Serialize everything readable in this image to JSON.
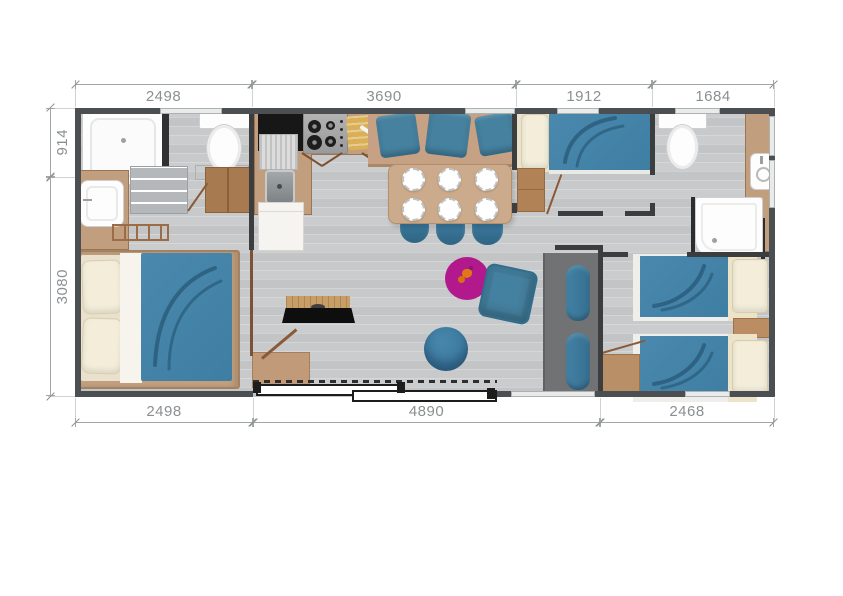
{
  "title": "Mobile home floor plan",
  "dimensions": {
    "top": [
      {
        "label": "2498"
      },
      {
        "label": "3690"
      },
      {
        "label": "1912"
      },
      {
        "label": "1684"
      }
    ],
    "bottom": [
      {
        "label": "2498"
      },
      {
        "label": "4890"
      },
      {
        "label": "2468"
      }
    ],
    "left": [
      {
        "label": "914"
      },
      {
        "label": "3080"
      }
    ]
  },
  "colors": {
    "wall": "#4c4f51",
    "interior_wall": "#3b3d3f",
    "floor_gray": "#c7c9ca",
    "wood_tan": "#c19e7d",
    "fabric_blue": "#4584a9",
    "cushion_blue": "#46829f",
    "pillow_cream": "#f3edda",
    "fixture_white": "#fdfdfd",
    "counter_black": "#171717",
    "sofa_gray": "#707274",
    "rug_magenta": "#b2198c",
    "figure_orange": "#e07818",
    "dimension_text": "#8b8f91",
    "cutting_board": "#d9b058"
  },
  "rooms": {
    "bathroom_left": {
      "furniture": [
        "shower",
        "washbasin",
        "toilet",
        "towel-ladder",
        "wardrobe"
      ]
    },
    "kitchen": {
      "furniture": [
        "black-counter",
        "sink-with-drainer",
        "hob-4-burners",
        "cutting-board-knife",
        "fridge"
      ]
    },
    "dining": {
      "furniture": [
        "bench-3-cushions",
        "table-6-plates",
        "3-chairs"
      ]
    },
    "master_bedroom": {
      "furniture": [
        "double-bed",
        "2-pillows"
      ]
    },
    "living": {
      "furniture": [
        "tv-on-shelf",
        "desk",
        "round-rug",
        "floor-cushion",
        "pouf",
        "sofa-2-cushions",
        "sliding-bay-door"
      ]
    },
    "bedroom_middle": {
      "furniture": [
        "double-bed",
        "pillow",
        "low-wardrobe"
      ]
    },
    "bathroom_right": {
      "furniture": [
        "toilet",
        "washbasin",
        "shower"
      ]
    },
    "twin_bedroom": {
      "furniture": [
        "twin-bed",
        "twin-bed",
        "nightstand",
        "corner-unit"
      ]
    }
  }
}
